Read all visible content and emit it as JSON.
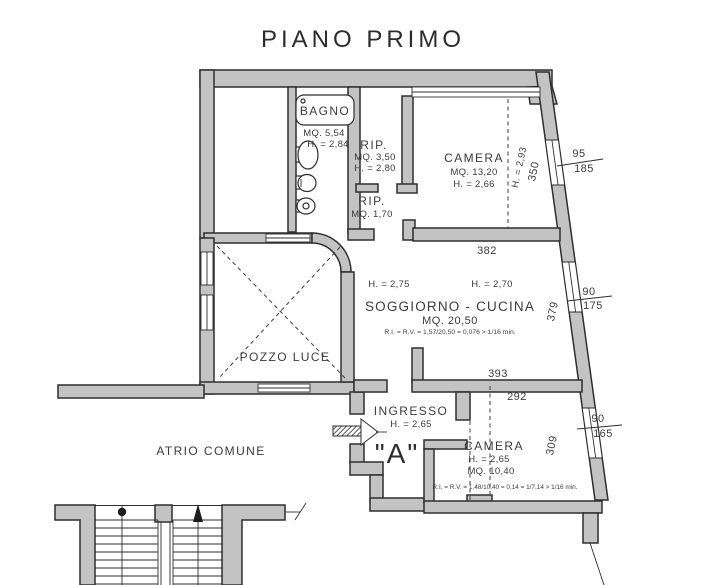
{
  "title": "PIANO PRIMO",
  "unit_label": "\"A\"",
  "rooms": {
    "bagno": {
      "name": "BAGNO",
      "area": "MQ. 5,54",
      "height": "H. = 2,84"
    },
    "rip1": {
      "name": "RIP.",
      "area": "MQ. 3,50",
      "height": "H. = 2,80"
    },
    "rip2": {
      "name": "RIP.",
      "area": "MQ. 1,70"
    },
    "camera1": {
      "name": "CAMERA",
      "area": "MQ. 13,20",
      "height": "H. = 2,66",
      "beam_height": "H. = 2,93",
      "beam_span": "350"
    },
    "soggiorno": {
      "name": "SOGGIORNO - CUCINA",
      "area": "MQ. 20,50",
      "ratio": "R.I. = R.V. = 1,57/20,50 = 0,076 > 1/16 min.",
      "height_left": "H. = 2,75",
      "height_right": "H. = 2,70",
      "dim_top": "382",
      "dim_bottom": "393",
      "dim_right": "379"
    },
    "pozzo_luce": {
      "name": "POZZO LUCE"
    },
    "ingresso": {
      "name": "INGRESSO",
      "height": "H. = 2,65"
    },
    "camera2": {
      "name": "CAMERA",
      "height": "H. = 2,65",
      "area": "MQ. 10,40",
      "ratio": "R.I. = R.V. = 1,48/10,40 = 0,14 = 1/7,14 > 1/16 min.",
      "dim_top": "292",
      "dim_right": "309"
    },
    "atrio": {
      "name": "ATRIO COMUNE"
    }
  },
  "windows": {
    "w1": {
      "over": "95",
      "under": "185"
    },
    "w2": {
      "over": "90",
      "under": "175"
    },
    "w3": {
      "over": "90",
      "under": "165"
    }
  },
  "colors": {
    "wall_fill": "#c3c3c3",
    "line": "#2e2e2e",
    "text": "#3b3b3b"
  }
}
